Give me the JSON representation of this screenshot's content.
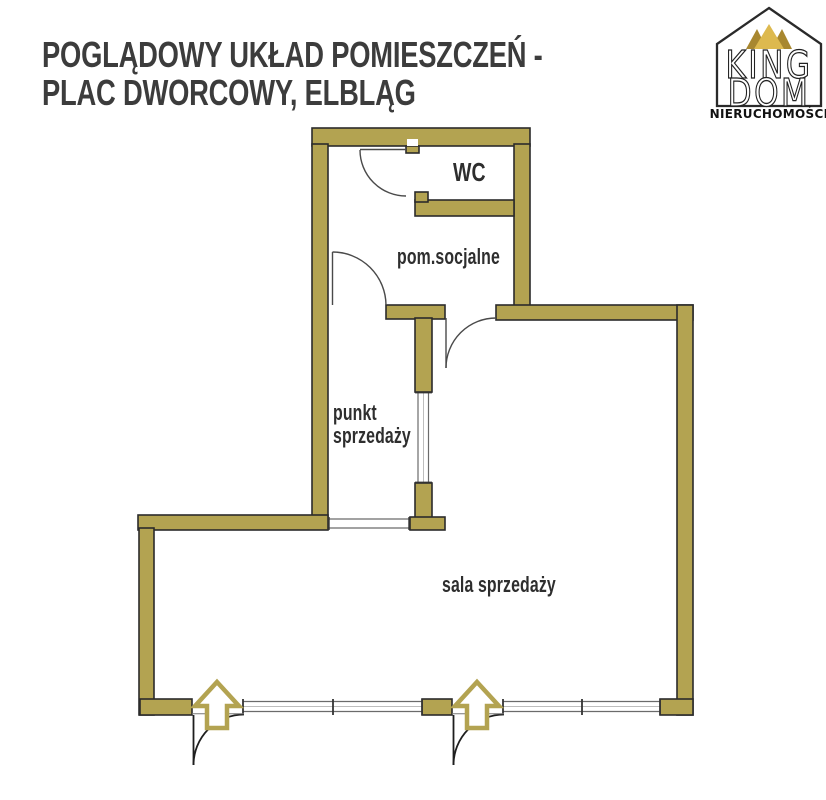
{
  "title": "POGLĄDOWY UKŁAD POMIESZCZEŃ -\nPLAC DWORCOWY, ELBLĄG",
  "logo": {
    "word1": "KING",
    "word2": "DOM",
    "subtitle": "NIERUCHOMOŚCI"
  },
  "rooms": {
    "wc": "WC",
    "social": "pom.socjalne",
    "sales_point": "punkt\nsprzedaży",
    "sales_hall": "sala sprzedaży"
  },
  "colors": {
    "wall": "#b3a351",
    "wall_outline": "#2b2b2b",
    "door_line": "#4a4a4a",
    "entrance_door_line": "#1e1e1e",
    "window_line": "#6b6b6b",
    "arrow": "#b3a351",
    "crown_dark": "#a8872f",
    "crown_light": "#ddb94f",
    "logo_outline": "#2a2a2a",
    "text": "#2e2e2e",
    "title_text": "#3c3c3c"
  }
}
